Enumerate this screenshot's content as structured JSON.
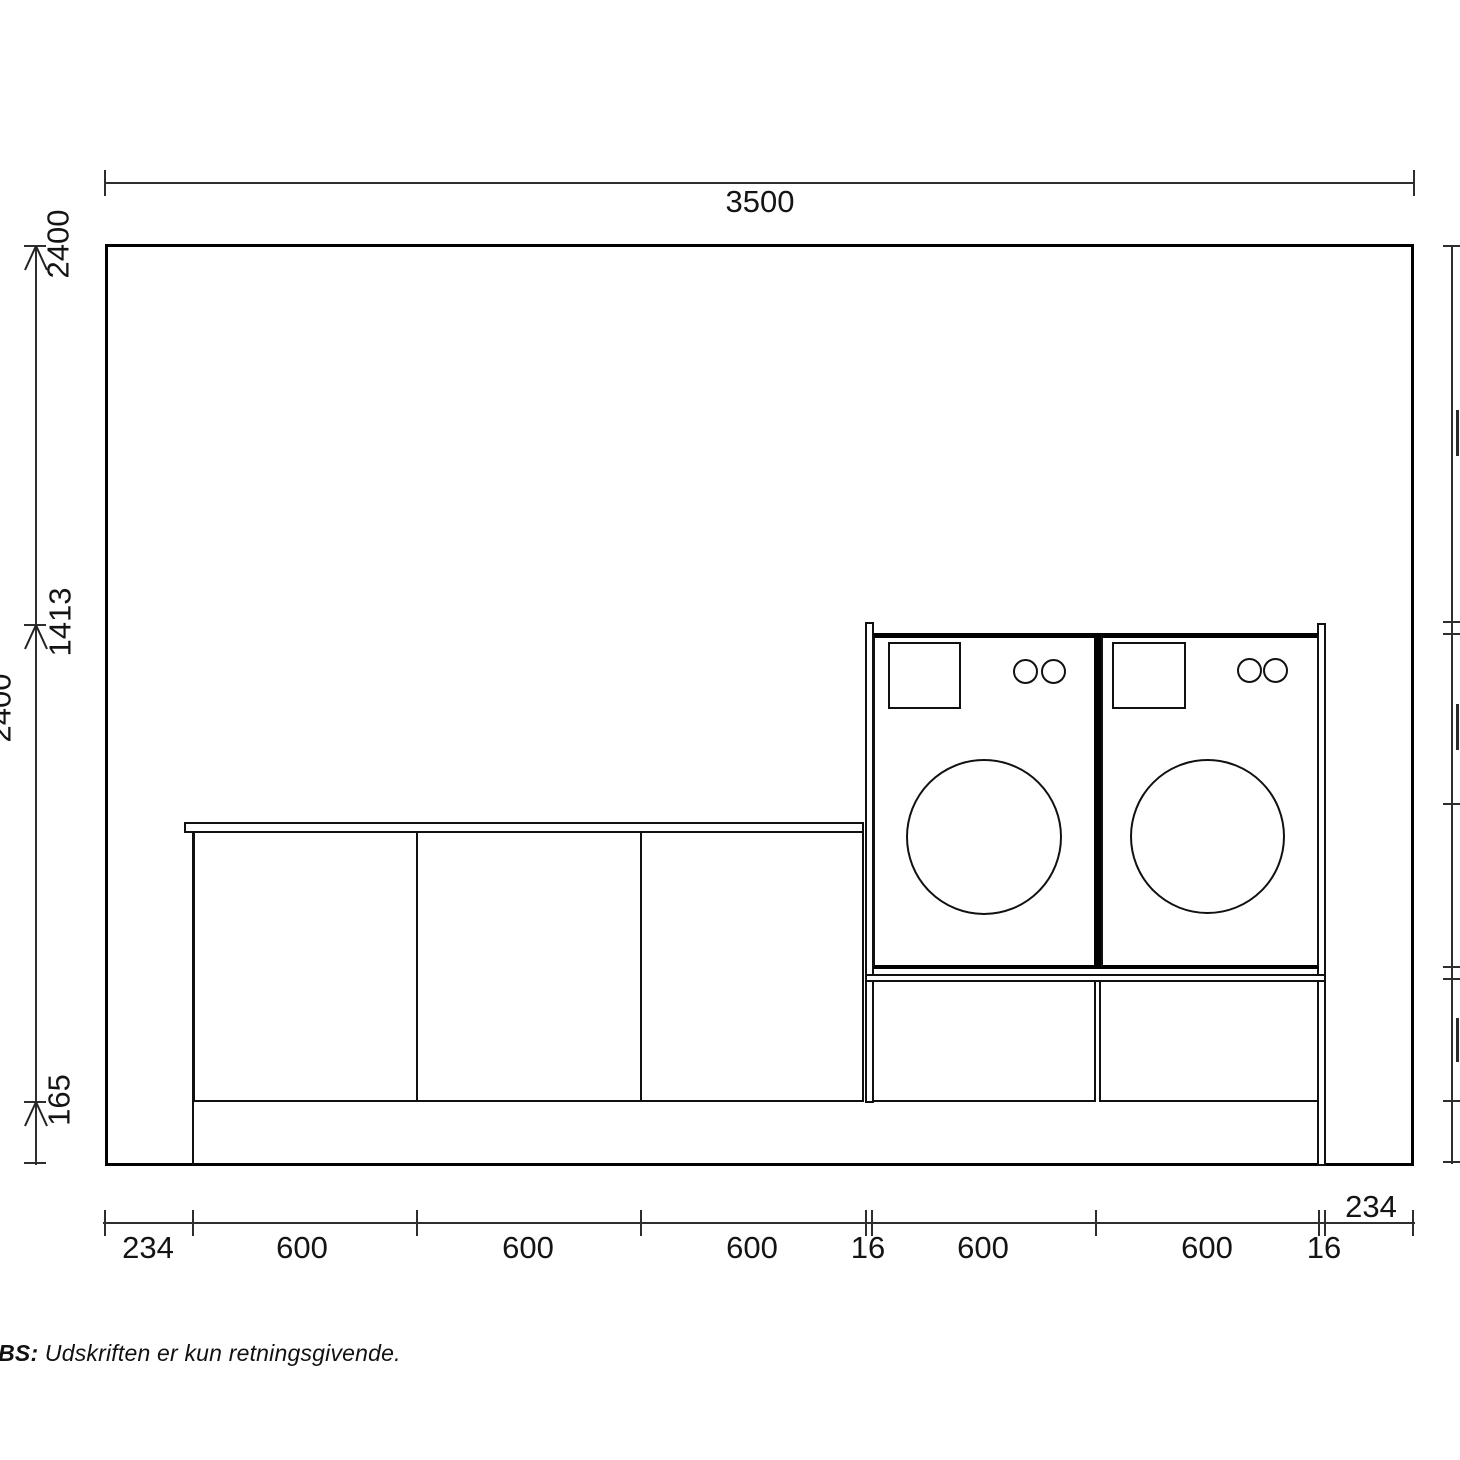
{
  "dims": {
    "top_total": "3500",
    "left": {
      "wall_height": "2400",
      "washer_top": "1413",
      "plinth": "165",
      "full_height": "2400"
    },
    "bottom": [
      "234",
      "600",
      "600",
      "600",
      "16",
      "600",
      "600",
      "16",
      "234"
    ]
  },
  "footer": {
    "label": "OBS:",
    "note": "Udskriften er kun retningsgivende."
  }
}
